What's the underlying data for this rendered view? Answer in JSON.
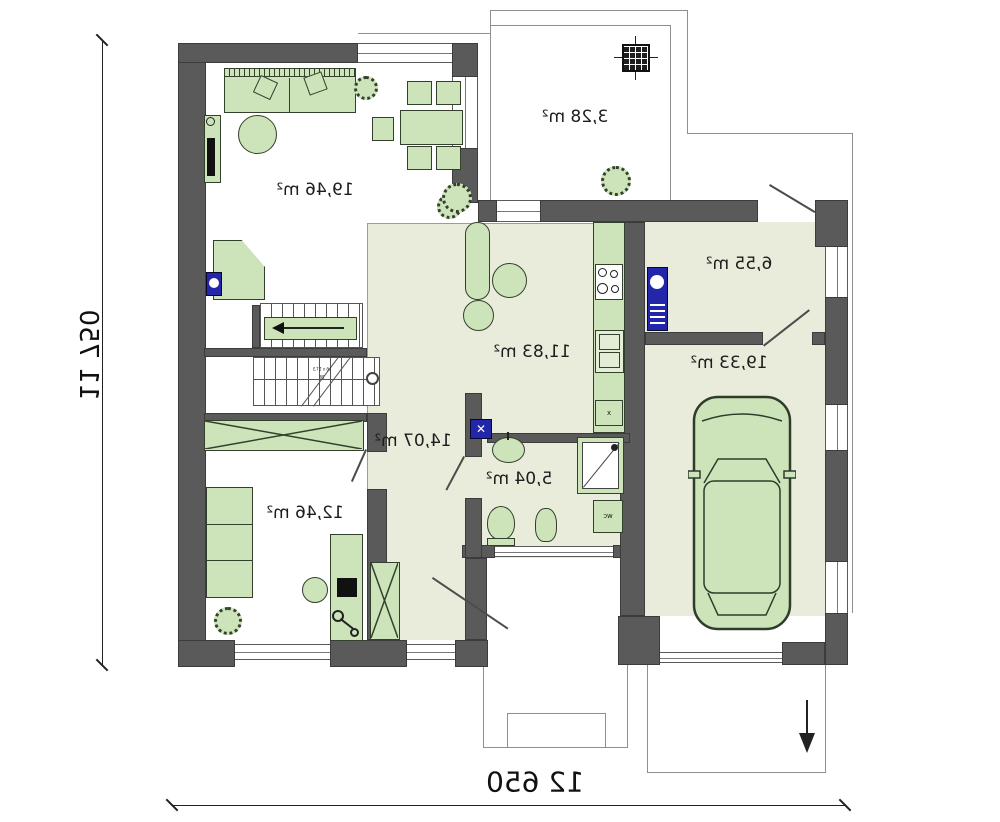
{
  "rooms": [
    {
      "name": "living-room",
      "label": "19,46 m²"
    },
    {
      "name": "kitchen",
      "label": "11,83 m²"
    },
    {
      "name": "hall",
      "label": "14,07 m²"
    },
    {
      "name": "bedroom",
      "label": "12,46 m²"
    },
    {
      "name": "bathroom",
      "label": "5,04 m²"
    },
    {
      "name": "utility-room",
      "label": "6,55 m²"
    },
    {
      "name": "garage",
      "label": "19,33 m²"
    },
    {
      "name": "porch",
      "label": "3,28 m²"
    }
  ],
  "dimensions": {
    "vertical": "11 750",
    "horizontal": "12 650"
  },
  "annotations": {
    "wc_shaft": "wc",
    "stair_note_line1": "16 x 17,5",
    "stair_note_line2": "28",
    "sink_mark": "x"
  },
  "colors": {
    "wall": "#5a5a5a",
    "floor": "#e9ecda",
    "furniture": "#cde4ba",
    "appliance": "#2326a8"
  }
}
